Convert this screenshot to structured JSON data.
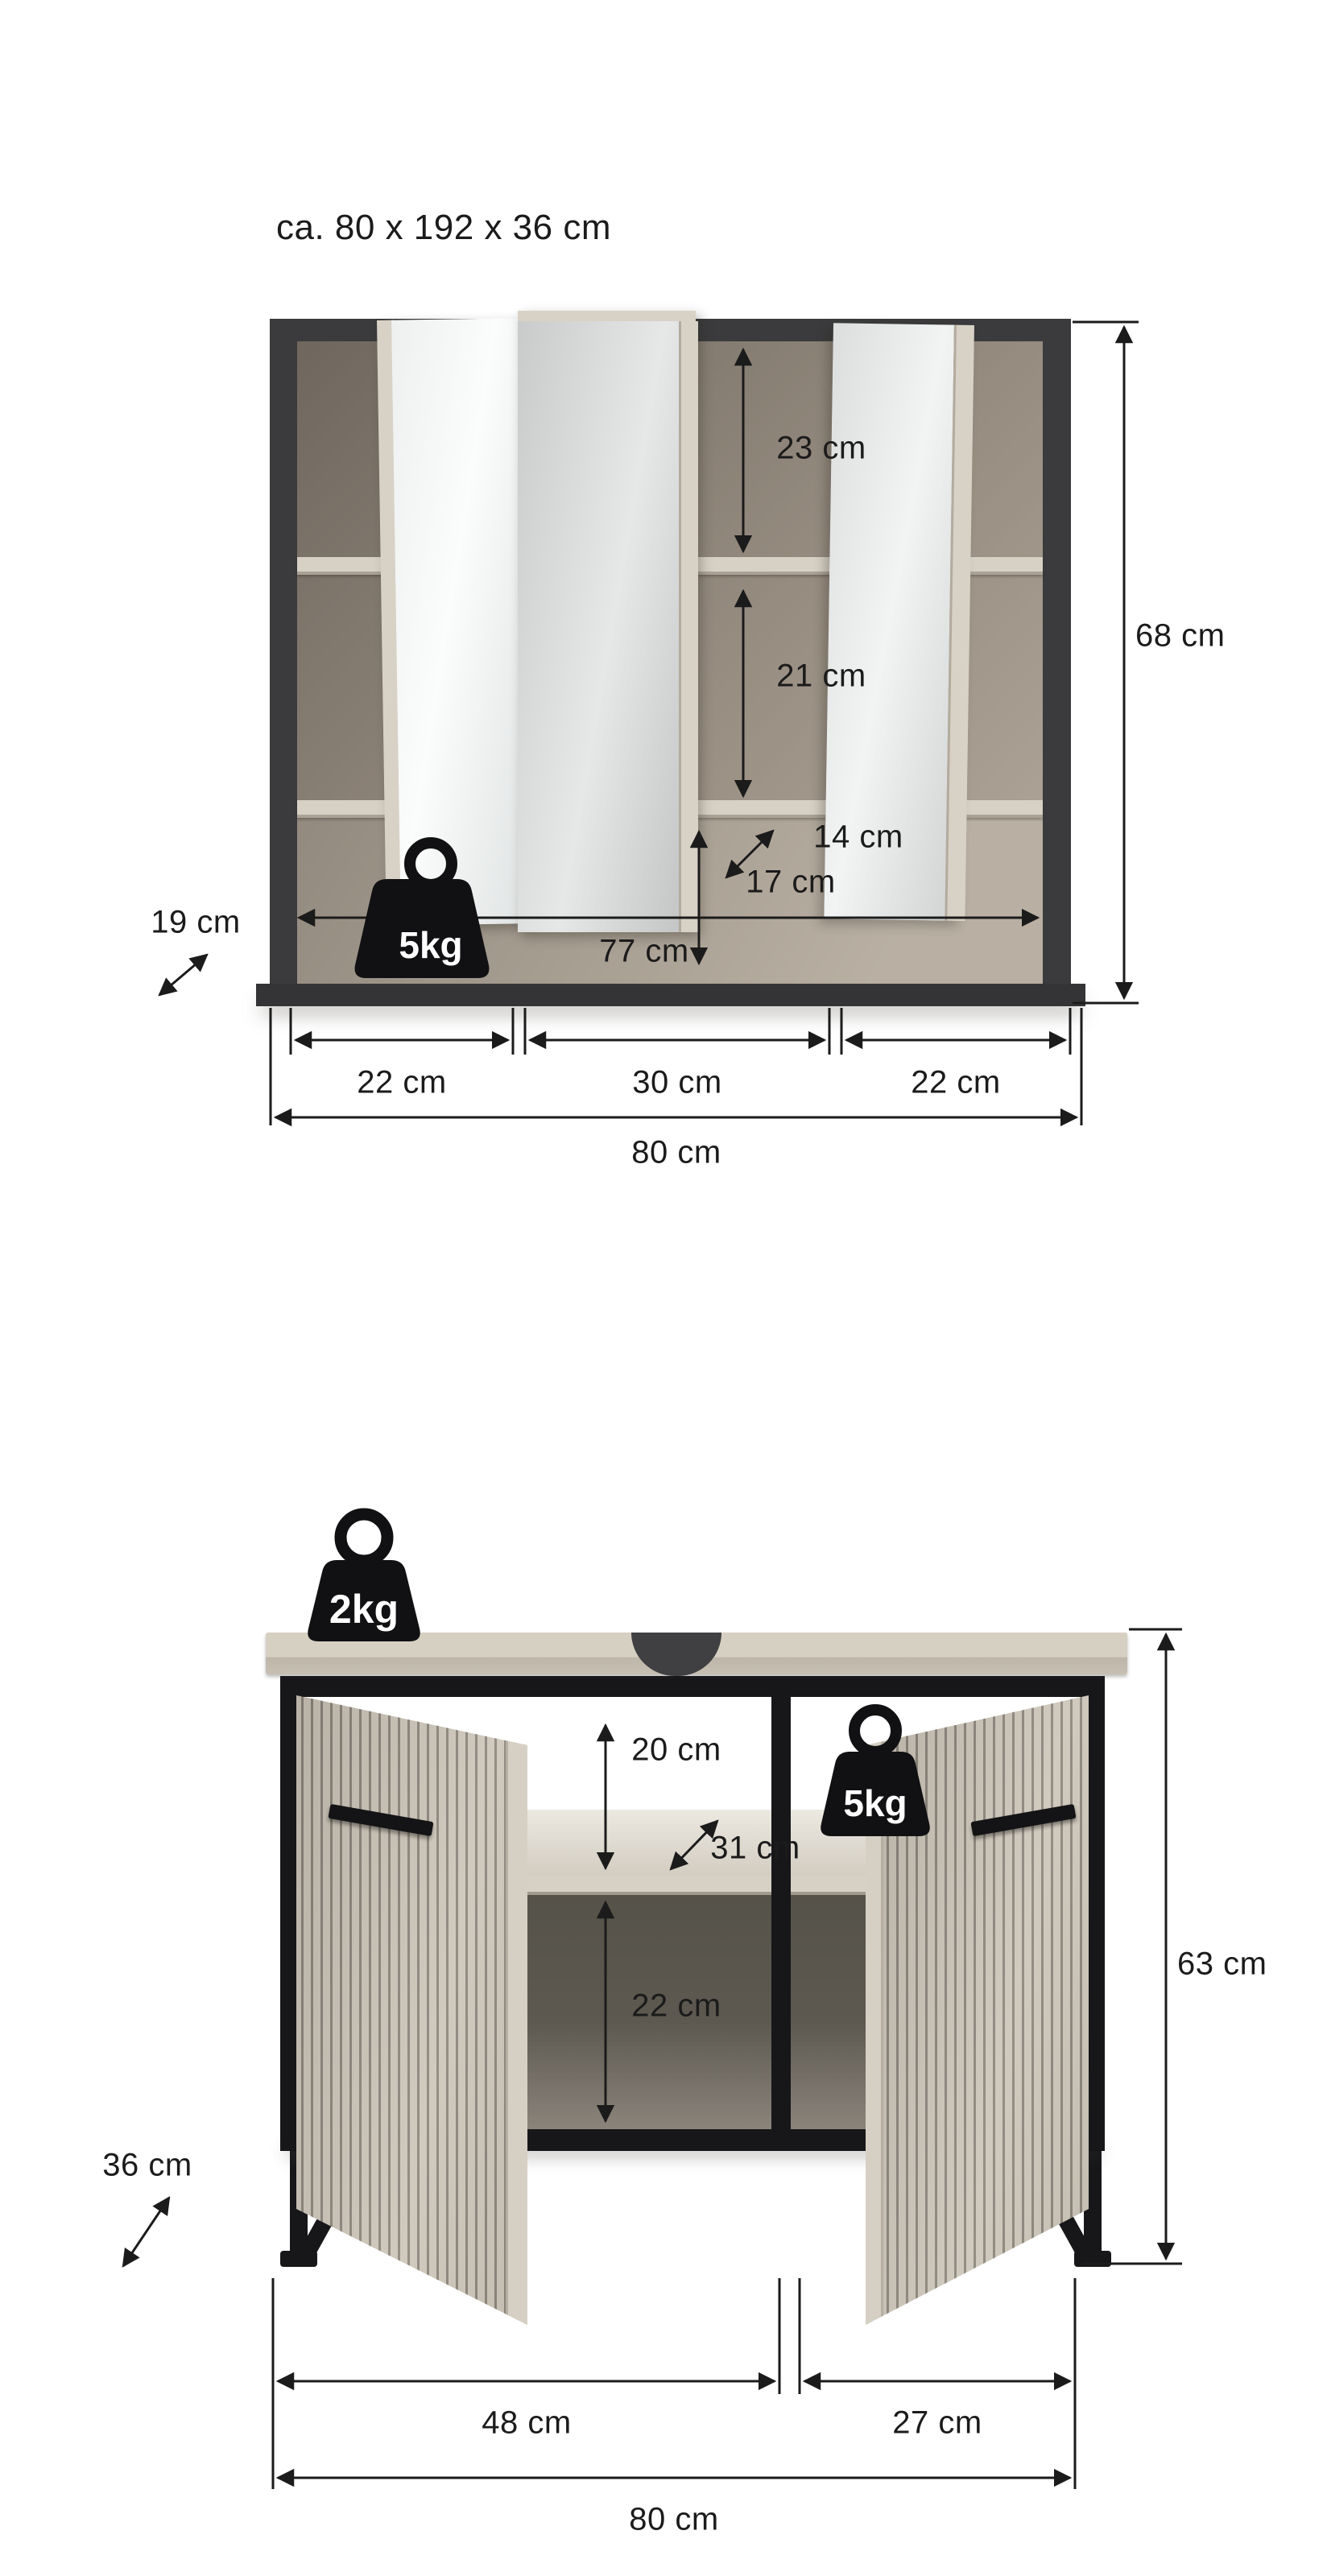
{
  "title": "ca. 80 x 192 x 36 cm",
  "mirror_cabinet": {
    "load_label": "5kg",
    "dims": {
      "upper_shelf_height": "23 cm",
      "middle_shelf_height": "21 cm",
      "shelf_depth": "14 cm",
      "open_shelf_height": "17 cm",
      "inner_width": "77 cm",
      "height": "68 cm",
      "depth": "19 cm",
      "left_section_width": "22 cm",
      "middle_section_width": "30 cm",
      "right_section_width": "22 cm",
      "total_width": "80 cm"
    }
  },
  "vanity_cabinet": {
    "top_load_label": "2kg",
    "inner_load_label": "5kg",
    "dims": {
      "upper_niche_height": "20 cm",
      "shelf_depth": "31 cm",
      "lower_niche_height": "22 cm",
      "height": "63 cm",
      "depth": "36 cm",
      "left_section_width": "48 cm",
      "right_section_width": "27 cm",
      "total_width": "80 cm"
    }
  },
  "colors": {
    "frame_charcoal": "#3b3b3d",
    "metal_black": "#17171a",
    "wood_beige": "#cdc6b9",
    "shelf_cream": "#d8d2c6",
    "interior_taupe": "#8a8177",
    "annotation": "#1b1b1b"
  }
}
